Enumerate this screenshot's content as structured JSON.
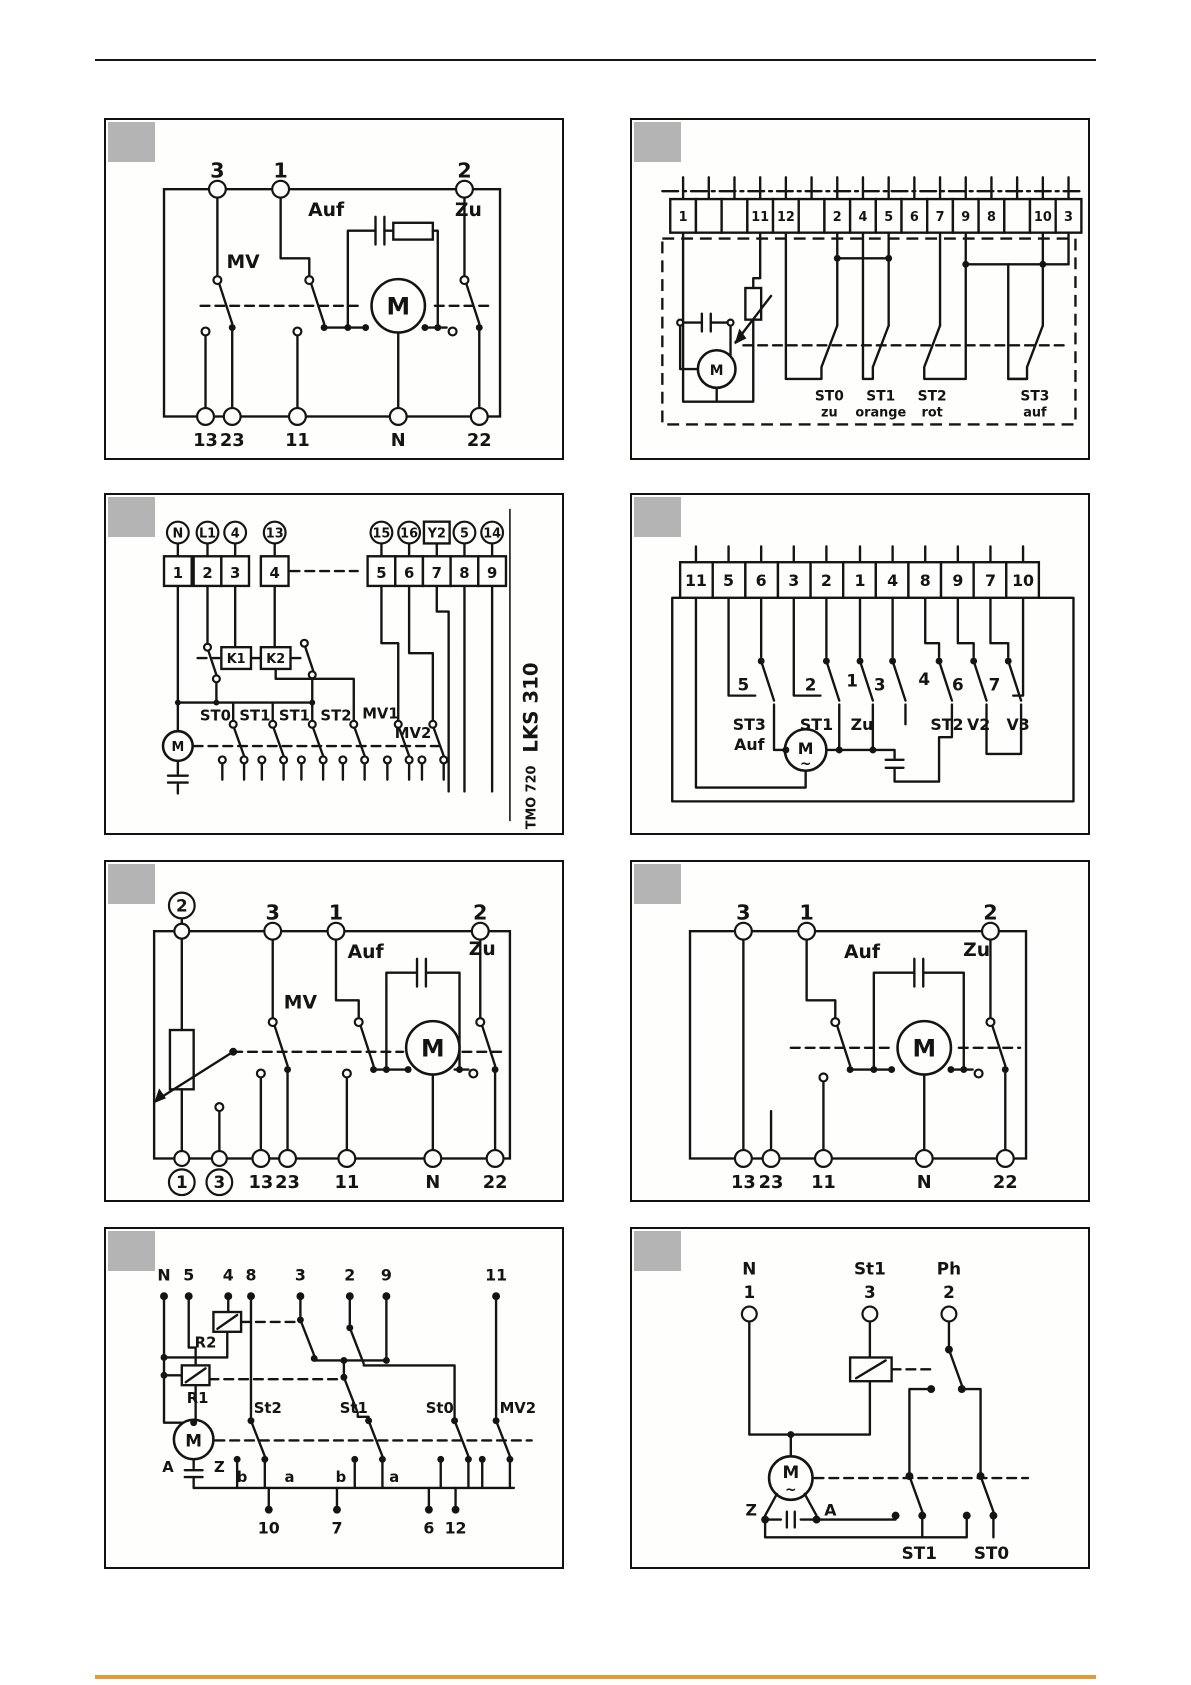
{
  "page": {
    "ink_color": "#141414",
    "badge_color": "#b4b4b4",
    "accent_color": "#e59b35"
  },
  "panels": {
    "p1": {
      "top": [
        "3",
        "1",
        "2"
      ],
      "bottom": [
        "13",
        "23",
        "11",
        "N",
        "22"
      ],
      "mv": "MV",
      "auf": "Auf",
      "zu": "Zu",
      "motor": "M"
    },
    "p2": {
      "cells": [
        "1",
        "",
        "",
        "11",
        "12",
        "",
        "2",
        "4",
        "5",
        "6",
        "7",
        "9",
        "8",
        "",
        "10",
        "3"
      ],
      "switches": [
        {
          "label": "ST0",
          "color": "zu"
        },
        {
          "label": "ST1",
          "color": "orange"
        },
        {
          "label": "ST2",
          "color": "rot"
        },
        {
          "label": "ST3",
          "color": "auf"
        }
      ],
      "motor": "M"
    },
    "p3": {
      "circles": [
        "N",
        "L1",
        "4",
        "13",
        "15",
        "16",
        "Y2",
        "5",
        "14"
      ],
      "cells": [
        "1",
        "2",
        "3",
        "4",
        "5",
        "6",
        "7",
        "8",
        "9"
      ],
      "relays": [
        "K1",
        "K2"
      ],
      "switches": [
        "ST0",
        "ST1",
        "ST1",
        "ST2",
        "MV1",
        "MV2"
      ],
      "motor": "M",
      "side_top": "LKS 310",
      "side_bottom": "TMO 720"
    },
    "p4": {
      "cells": [
        "11",
        "5",
        "6",
        "3",
        "2",
        "1",
        "4",
        "8",
        "9",
        "7",
        "10"
      ],
      "switch_numbers": [
        "5",
        "2",
        "1",
        "3",
        "4",
        "6",
        "7"
      ],
      "switch_labels": [
        "ST3",
        "Auf",
        "ST1",
        "Zu",
        "ST2",
        "V2",
        "V3"
      ],
      "motor": "M",
      "motor_wave": "~"
    },
    "p5": {
      "circled_top": "2",
      "top": [
        "3",
        "1",
        "2"
      ],
      "circled_bottom": [
        "1",
        "3"
      ],
      "bottom": [
        "13",
        "23",
        "11",
        "N",
        "22"
      ],
      "mv": "MV",
      "auf": "Auf",
      "zu": "Zu",
      "motor": "M"
    },
    "p6": {
      "top": [
        "3",
        "1",
        "2"
      ],
      "bottom": [
        "13",
        "23",
        "11",
        "N",
        "22"
      ],
      "auf": "Auf",
      "zu": "Zu",
      "motor": "M"
    },
    "p7": {
      "top": [
        "N",
        "5",
        "4",
        "8",
        "3",
        "2",
        "9",
        "11"
      ],
      "relays": [
        "R2",
        "R1"
      ],
      "switches": [
        "St2",
        "St1",
        "St0",
        "MV2"
      ],
      "contacts": [
        "b",
        "a",
        "b",
        "a"
      ],
      "motor": "M",
      "motor_a": "A",
      "motor_z": "Z",
      "bottom": [
        "10",
        "7",
        "6",
        "12"
      ]
    },
    "p8": {
      "terminals": [
        {
          "name": "N",
          "num": "1"
        },
        {
          "name": "St1",
          "num": "3"
        },
        {
          "name": "Ph",
          "num": "2"
        }
      ],
      "motor": "M",
      "motor_wave": "~",
      "motor_z": "Z",
      "motor_a": "A",
      "switches": [
        "ST1",
        "ST0"
      ]
    }
  }
}
